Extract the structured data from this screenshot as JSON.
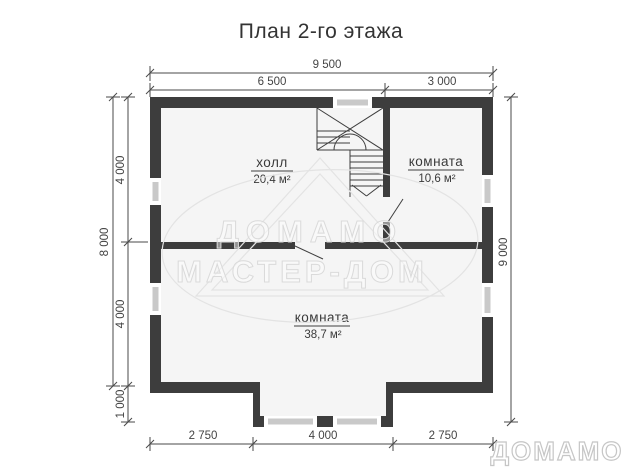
{
  "title": "План 2-го этажа",
  "colors": {
    "wall": "#3d3d3d",
    "floor": "#f5f5f5",
    "window_bar": "#c9c9c9",
    "dim_line": "#4a4a4a",
    "watermark": "#dadada"
  },
  "dims": {
    "width_total": "9 500",
    "width_left": "6 500",
    "width_right": "3 000",
    "height_total_left": "8 000",
    "height_upper": "4 000",
    "height_lower": "4 000",
    "bay_depth": "1 000",
    "height_total_right": "9 000",
    "bottom_left": "2 750",
    "bottom_center": "4 000",
    "bottom_right": "2 750"
  },
  "rooms": [
    {
      "name": "холл",
      "area": "20,4 м²"
    },
    {
      "name": "комната",
      "area": "10,6 м²"
    },
    {
      "name": "комната",
      "area": "38,7 м²"
    }
  ],
  "watermark": {
    "line1": "ДОМАМО",
    "line2": "МАСТЕР-ДОМ"
  },
  "logo": "ДОМАМО"
}
